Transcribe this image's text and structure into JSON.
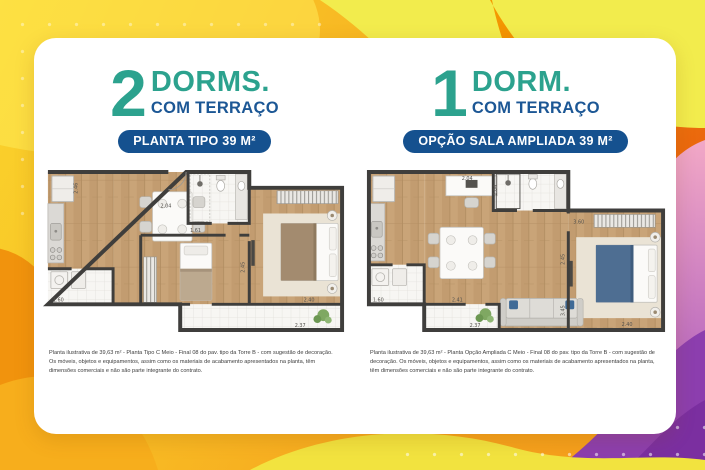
{
  "colors": {
    "teal": "#2CA28E",
    "blue": "#1C5795",
    "badge_blue": "#15518F",
    "wall": "#3F3E3C",
    "wood": "#C9A478",
    "bg_yellow": "#F5E93D",
    "bg_orange": "#F6A31D",
    "bg_pink": "#F2A8C6",
    "bg_purple": "#8C3EAE"
  },
  "panels": [
    {
      "number": "2",
      "type_label": "DORMS.",
      "terrace_label": "COM TERRAÇO",
      "badge": "PLANTA TIPO 39 M²",
      "caption": "Planta ilustrativa de 39,63 m² - Planta Tipo C Meio - Final 08 do pav. tipo da Torre B - com sugestão de decoração. Os móveis, objetos e equipamentos, assim como os materiais de acabamento apresentados na planta, têm dimensões comerciais e não são parte integrante do contrato.",
      "dims": {
        "kitchen": "2.46",
        "bath": "2.04",
        "hall": "1.61",
        "service": "1.60",
        "bedroom2": "2.45",
        "bedroom1": "2.40",
        "terrace": "2.37"
      }
    },
    {
      "number": "1",
      "type_label": "DORM.",
      "terrace_label": "COM TERRAÇO",
      "badge": "OPÇÃO SALA AMPLIADA 39 M²",
      "caption": "Planta ilustrativa de 39,63 m² - Planta Opção Ampliada C Meio - Final 08 do pav. tipo da Torre B - com sugestão de decoração. Os móveis, objetos e equipamentos, assim como os materiais de acabamento apresentados na planta, têm dimensões comerciais e não são parte integrante do contrato.",
      "dims": {
        "top": "2.04",
        "bath": "2.04",
        "wardrobe": "3.60",
        "bedroom_side": "2.45",
        "sofa_side": "3.45",
        "living": "2.41",
        "service": "1.60",
        "terrace": "2.37",
        "bed": "2.40"
      }
    }
  ]
}
